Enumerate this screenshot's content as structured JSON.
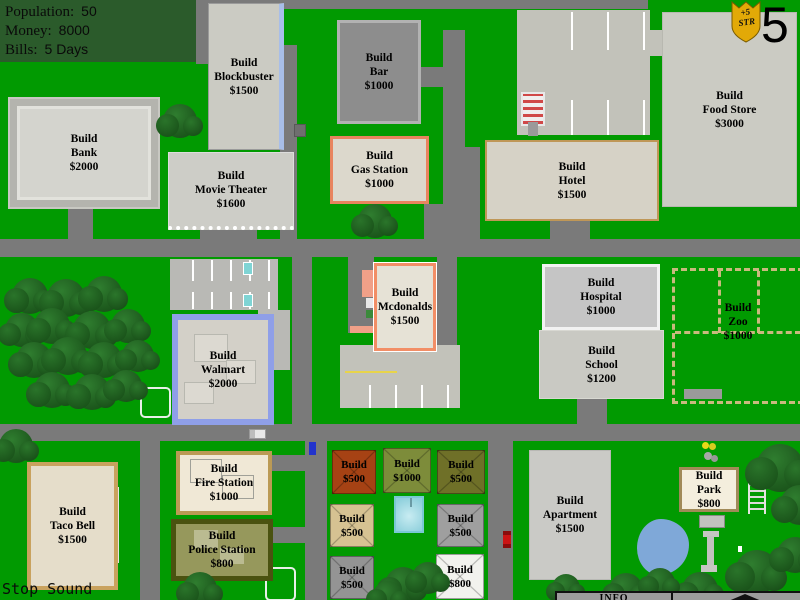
{
  "hud": {
    "rows": [
      {
        "label": "Population:",
        "value": "50"
      },
      {
        "label": "Money:",
        "value": "8000"
      },
      {
        "label": "Bills:",
        "value": "5 Days"
      }
    ]
  },
  "badge": {
    "bonus": "+5",
    "stat": "STR",
    "counter": "5"
  },
  "buildings": {
    "blockbuster": {
      "label": "Build\nBlockbuster\n$1500"
    },
    "bank": {
      "label": "Build\nBank\n$2000"
    },
    "movie_theater": {
      "label": "Build\nMovie Theater\n$1600"
    },
    "bar": {
      "label": "Build\nBar\n$1000"
    },
    "gas_station": {
      "label": "Build\nGas Station\n$1000"
    },
    "food_store": {
      "label": "Build\nFood Store\n$3000"
    },
    "hotel": {
      "label": "Build\nHotel\n$1500"
    },
    "mcdonalds": {
      "label": "Build\nMcdonalds\n$1500"
    },
    "hospital": {
      "label": "Build\nHospital\n$1000"
    },
    "school": {
      "label": "Build\nSchool\n$1200"
    },
    "zoo": {
      "label": "Build\nZoo\n$1000"
    },
    "walmart": {
      "label": "Build\nWalmart\n$2000"
    },
    "taco_bell": {
      "label": "Build\nTaco Bell\n$1500"
    },
    "fire_station": {
      "label": "Build\nFire Station\n$1000"
    },
    "police_station": {
      "label": "Build\nPolice Station\n$800"
    },
    "apartment": {
      "label": "Build\nApartment\n$1500"
    },
    "park": {
      "label": "Build\nPark\n$800"
    }
  },
  "houses": [
    {
      "label": "Build\n$500"
    },
    {
      "label": "Build\n$1000"
    },
    {
      "label": "Build\n$500"
    },
    {
      "label": "Build\n$500"
    },
    {
      "label": "Build\n$500"
    },
    {
      "label": "Build\n$500"
    },
    {
      "label": "Build\n$800"
    }
  ],
  "controls": {
    "stop_sound_label": "Stop Sound"
  },
  "info_bar": {
    "label": "INFO"
  },
  "colors": {
    "grass": "#019a01",
    "road": "#7a7a7a",
    "hud_panel": "#2b5b2b",
    "shield_gold": "#e2a907"
  }
}
